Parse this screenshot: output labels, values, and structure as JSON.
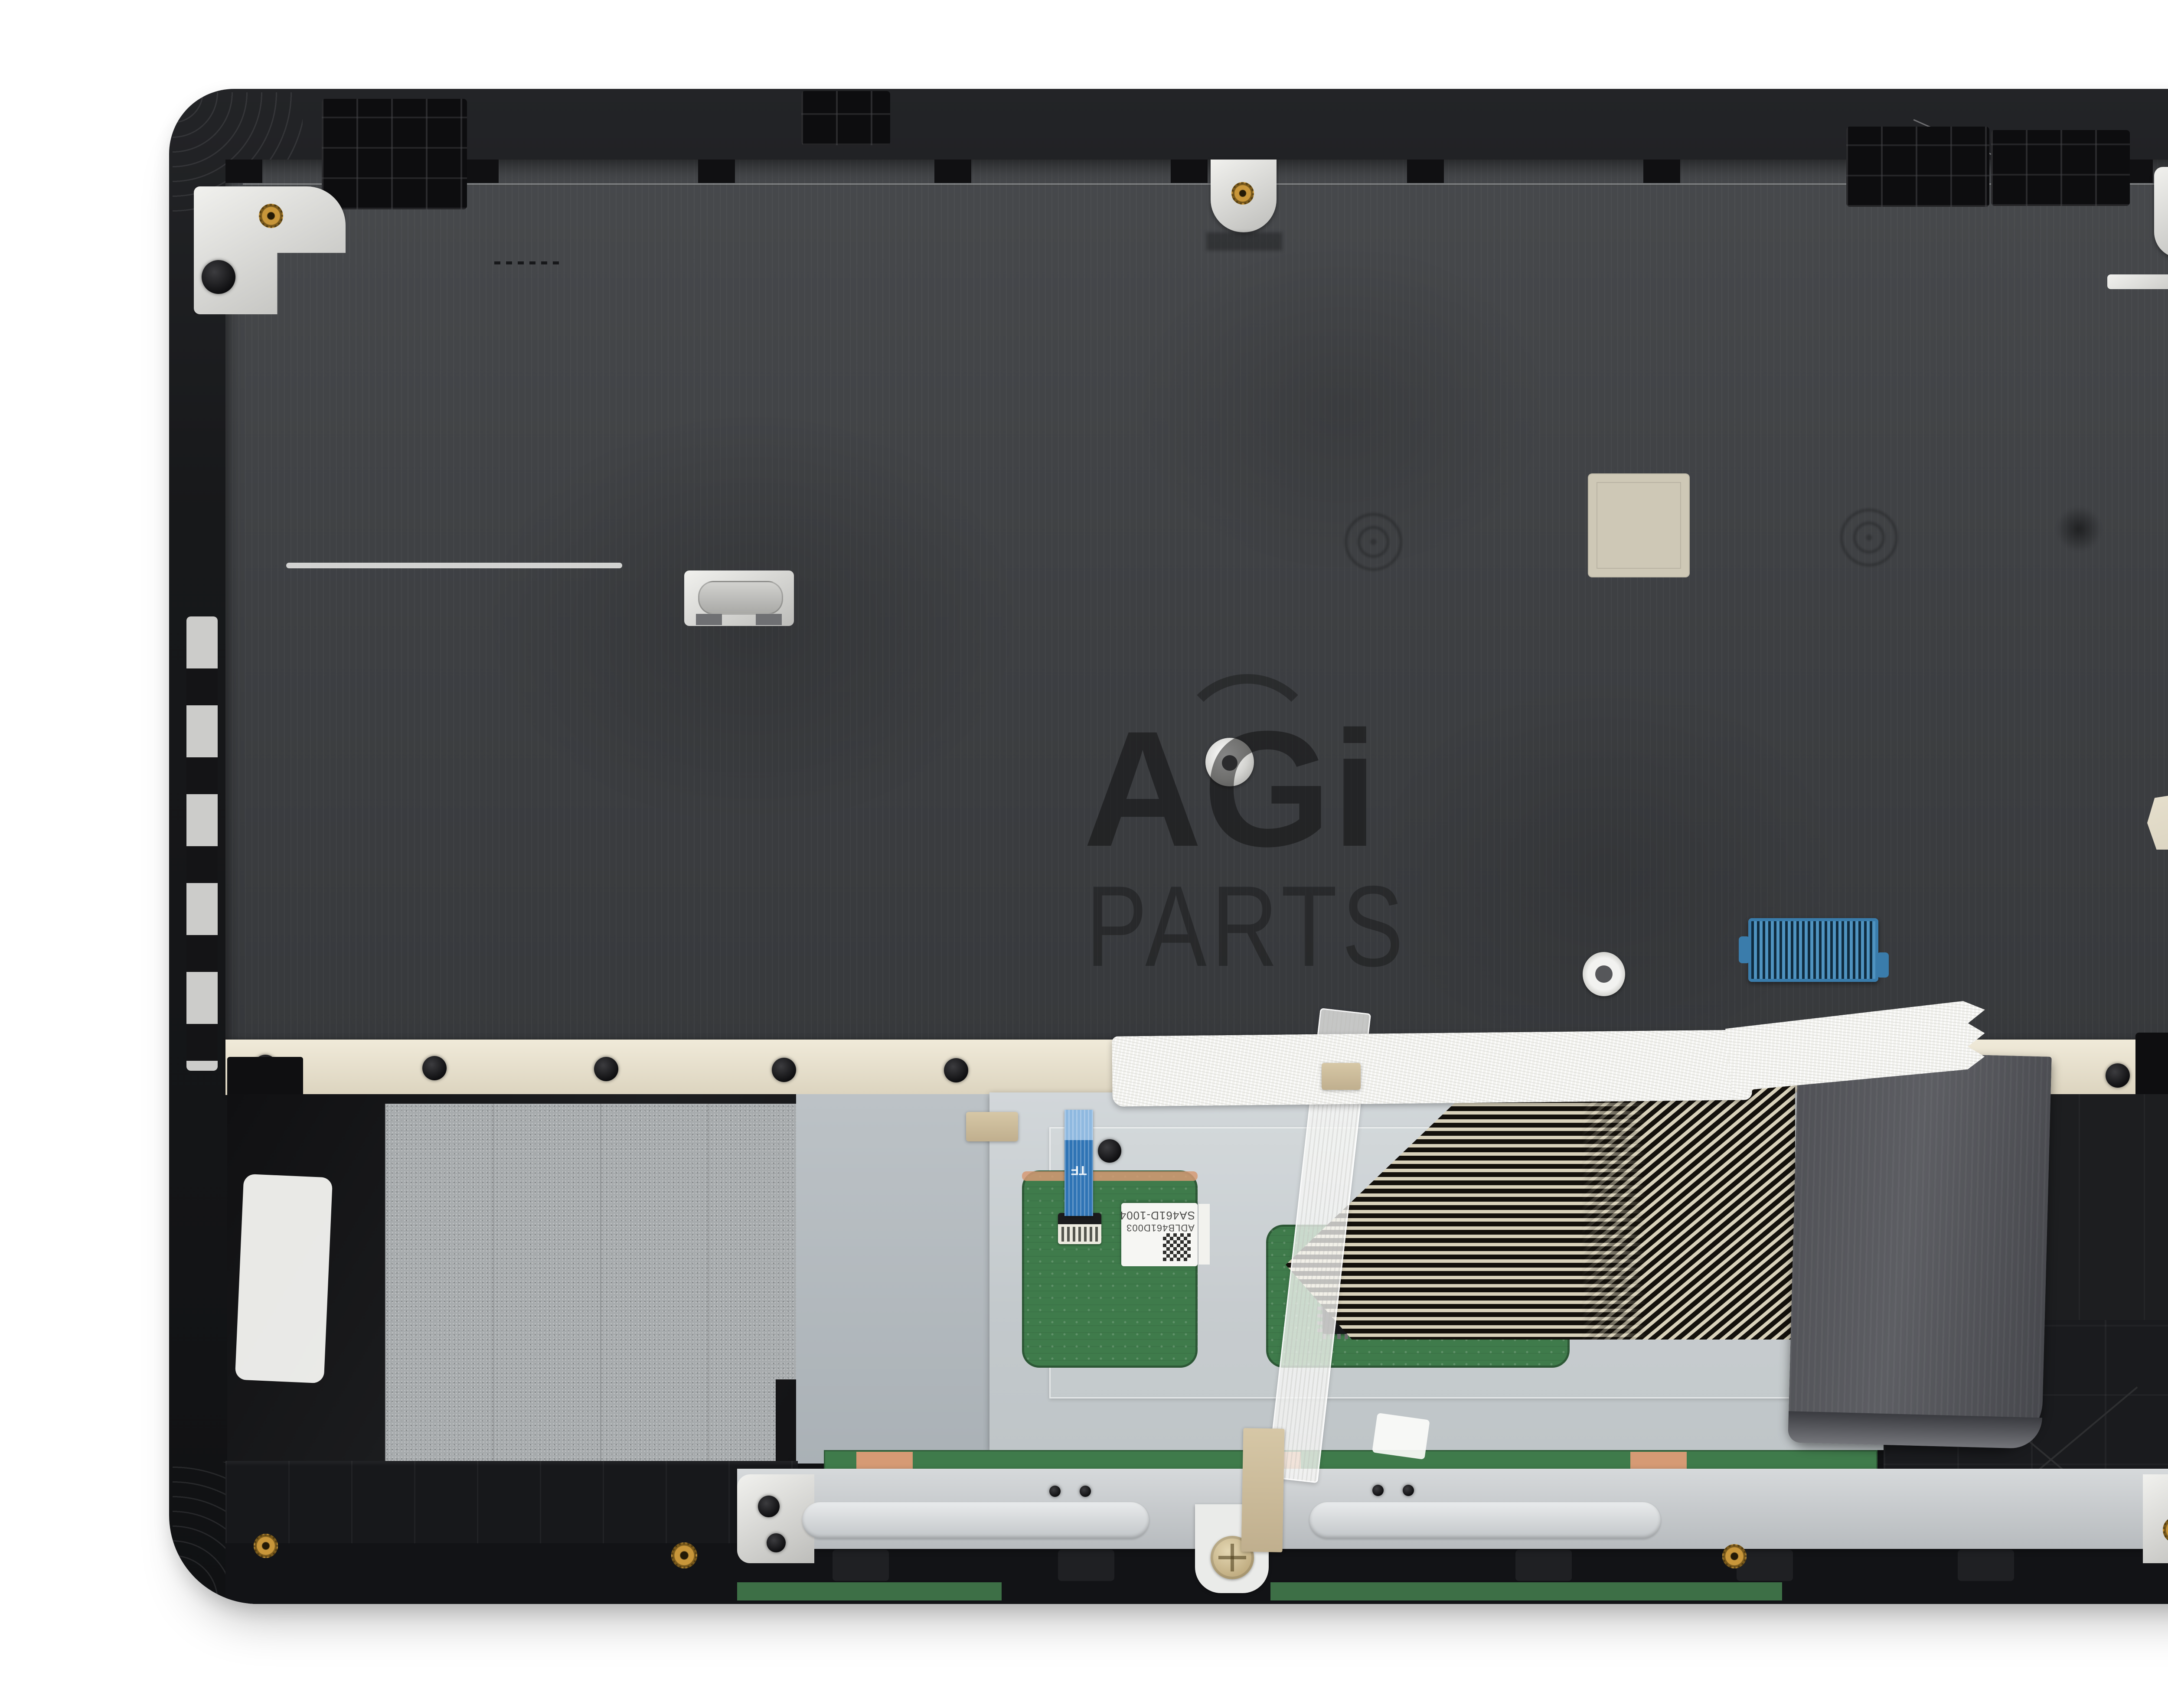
{
  "page": {
    "background": "#ffffff"
  },
  "watermark": {
    "brand": "AGi",
    "word": "PARTS"
  },
  "part_labels": {
    "touchpad_sticker_line1": "SA461D-1004",
    "touchpad_sticker_line2": "ADLB461D003",
    "cable_marking": "TF"
  },
  "logo": {
    "brand": "AGI",
    "caption": "AssetGenie Incorporated"
  },
  "colors": {
    "chassis_black": "#1a1b1d",
    "plate_gray": "#3e4043",
    "palmrest_gray": "#b7bec3",
    "touchpad_plate": "#ccd2d5",
    "pcb_green": "#3f7b4b",
    "copper": "#d69a74",
    "cream_metal": "#ece5d2",
    "tape_white": "#f3f3ef",
    "tape_tan": "#ccbc9a",
    "cable_blue": "#2f74b5",
    "connector_blue": "#3a7cab",
    "ribbon_dark": "#535459",
    "fpc_stripe": "#d8d1ba",
    "brass": "#c8963a",
    "logo_gray": "#9d9d9d",
    "logo_blue": "#7ec3e8",
    "map_dots": "#b7cde9"
  }
}
